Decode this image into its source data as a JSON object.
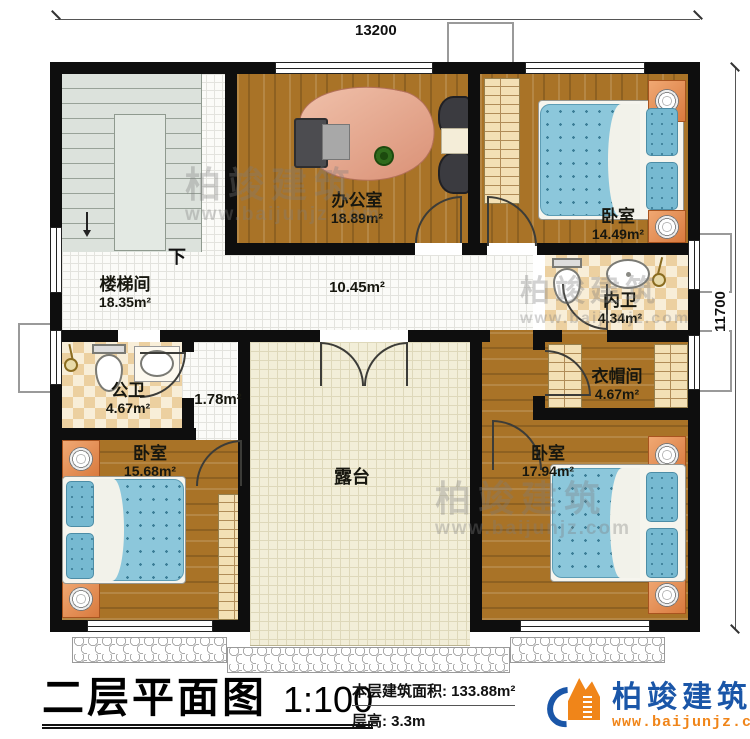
{
  "dimensions": {
    "top": "13200",
    "right": "11700"
  },
  "rooms": {
    "stair_hall": {
      "name": "楼梯间",
      "area": "18.35m²"
    },
    "office": {
      "name": "办公室",
      "area": "18.89m²"
    },
    "bedroom_top_right": {
      "name": "卧室",
      "area": "14.49m²"
    },
    "corridor": {
      "area": "10.45m²"
    },
    "inner_bath": {
      "name": "内卫",
      "area": "4.34m²"
    },
    "public_bath": {
      "name": "公卫",
      "area": "4.67m²"
    },
    "nook": {
      "area": "1.78m²"
    },
    "cloakroom": {
      "name": "衣帽间",
      "area": "4.67m²"
    },
    "bedroom_bottom_left": {
      "name": "卧室",
      "area": "15.68m²"
    },
    "terrace": {
      "name": "露台"
    },
    "bedroom_bottom_right": {
      "name": "卧室",
      "area": "17.94m²"
    }
  },
  "annotations": {
    "stairs_down": "下"
  },
  "footer": {
    "title": "二层平面图",
    "scale": "1:100",
    "area_label": "本层建筑面积:",
    "area_value": "133.88m²",
    "height_label": "层高:",
    "height_value": "3.3m"
  },
  "brand": {
    "name": "柏竣建筑",
    "website": "www.baijunjz.com"
  },
  "watermark": {
    "line1": "柏竣建筑",
    "line2": "www.baijunjz.com"
  },
  "colors": {
    "wall": "#0e0e0e",
    "wood": "#a97327",
    "terrace_tile": "#f2eed8",
    "bath_tile": "#ecd0a0",
    "mattress": "#8cc7db",
    "brand_blue": "#1a56a8",
    "brand_orange": "#f08519"
  }
}
